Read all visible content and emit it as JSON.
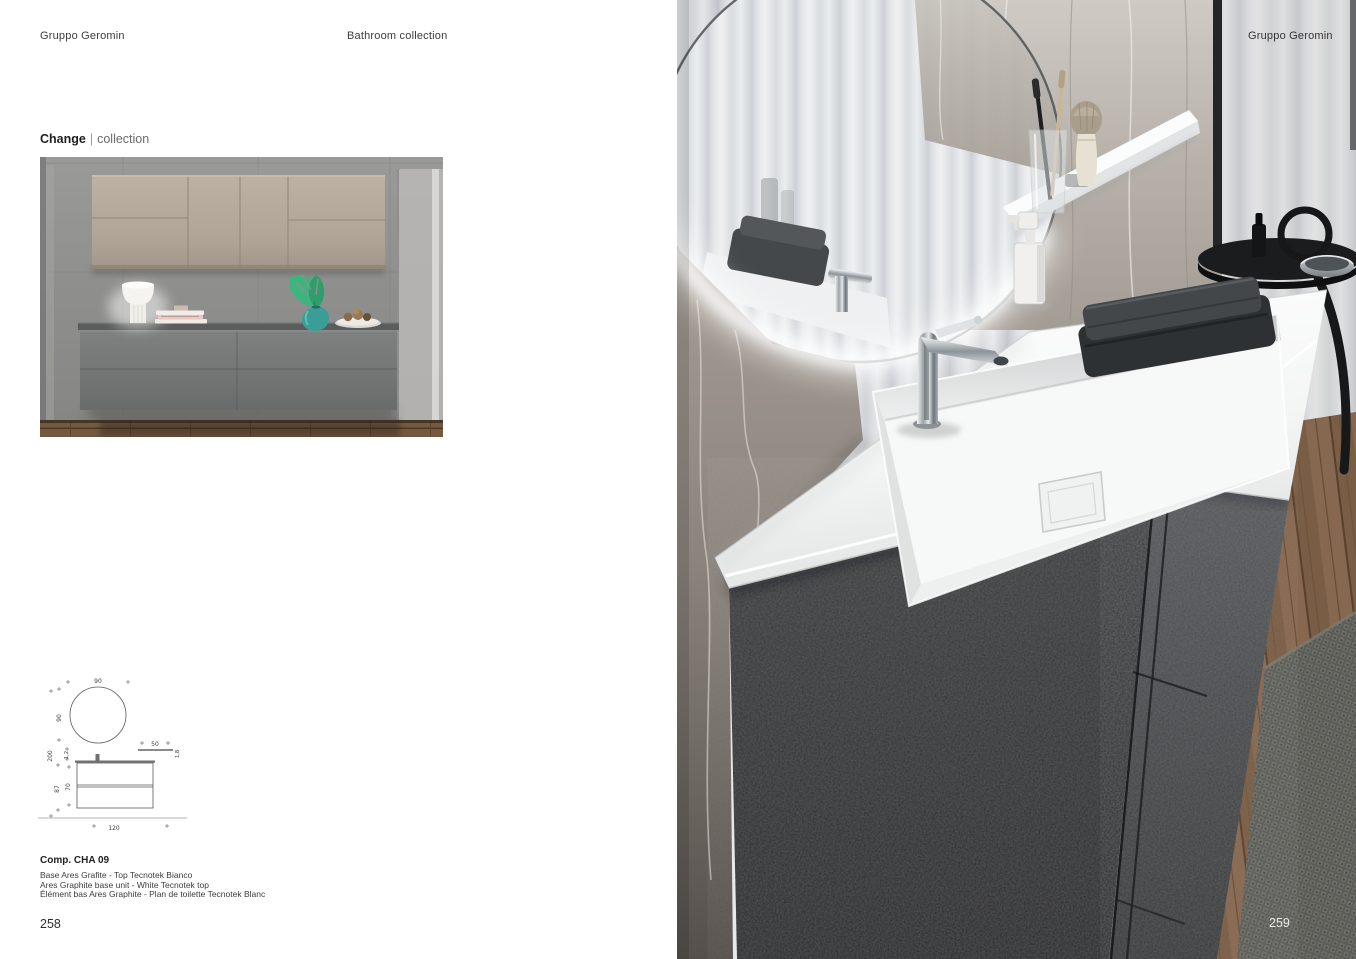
{
  "left_page": {
    "header_left": "Gruppo Geromin",
    "header_center": "Bathroom collection",
    "collection_name": "Change",
    "collection_separator": "|",
    "collection_suffix": "collection",
    "composition_code": "Comp. CHA 09",
    "description_it": "Base Ares Grafite - Top Tecnotek Bianco",
    "description_en": "Ares Graphite base unit - White Tecnotek top",
    "description_fr": "Élément bas Ares Graphite - Plan de toilette Tecnotek Blanc",
    "page_number": "258"
  },
  "right_page": {
    "header_right": "Gruppo Geromin",
    "page_number": "259"
  },
  "diagram": {
    "dims": {
      "mirror_width": "90",
      "mirror_height": "90",
      "total_height": "200",
      "top_thickness": "1,2",
      "shelf_width": "50",
      "shelf_thickness": "1,8",
      "unit_height": "87",
      "drawer_front_height": "70",
      "base_width": "120"
    }
  },
  "palette": {
    "wall_cabinet_beige": "#b3a89b",
    "base_unit_graphite": "#3c3e40",
    "counter_dark_gray": "#5f6260",
    "vase_teal": "#3a9e96",
    "leaf_green": "#3eb57e",
    "wood_floor_brown": "#75593f",
    "marble_gray": "#9a938c",
    "led_glow_white": "#ffffff",
    "towel_dark_gray": "#34373a"
  }
}
